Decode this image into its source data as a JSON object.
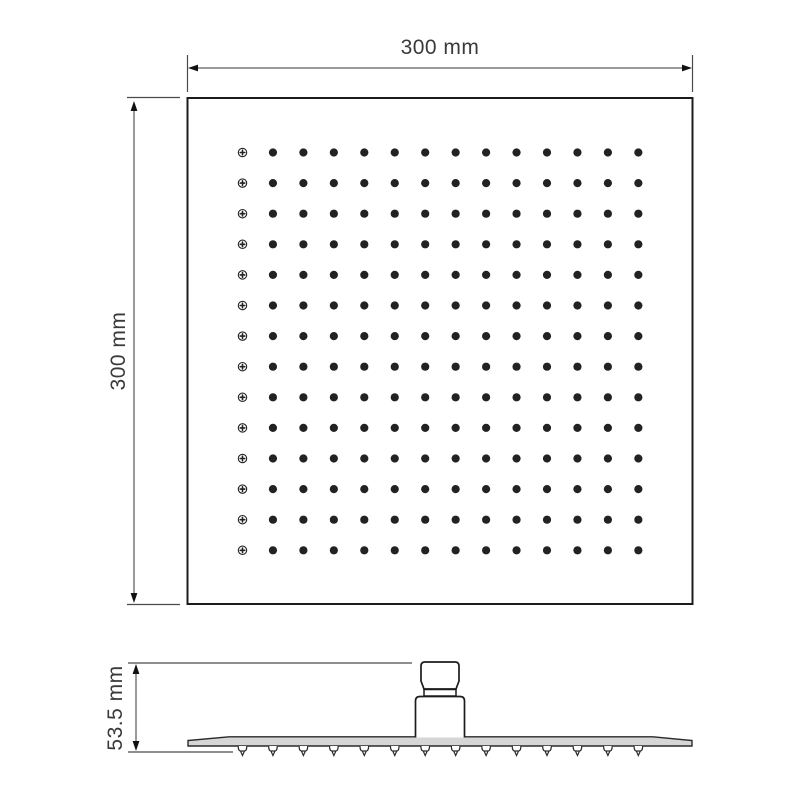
{
  "drawing": {
    "type": "technical-dimension-drawing",
    "subject": "square rain shower head",
    "top_view": {
      "width_label": "300 mm",
      "height_label": "300 mm",
      "grid": {
        "rows": 14,
        "cols": 14,
        "total_nozzles": 196,
        "first_column_glyph": "crosshair-circle",
        "dot_color": "#222222"
      }
    },
    "side_view": {
      "height_label": "53.5 mm",
      "nozzle_count": 14
    },
    "colors": {
      "outline": "#1c1c1c",
      "dimension_line": "#9a9a9a",
      "extension_line": "#4a4a4a",
      "arrow": "#111111",
      "text": "#3a3a3a",
      "plate_fill": "#d6d6d6"
    }
  }
}
